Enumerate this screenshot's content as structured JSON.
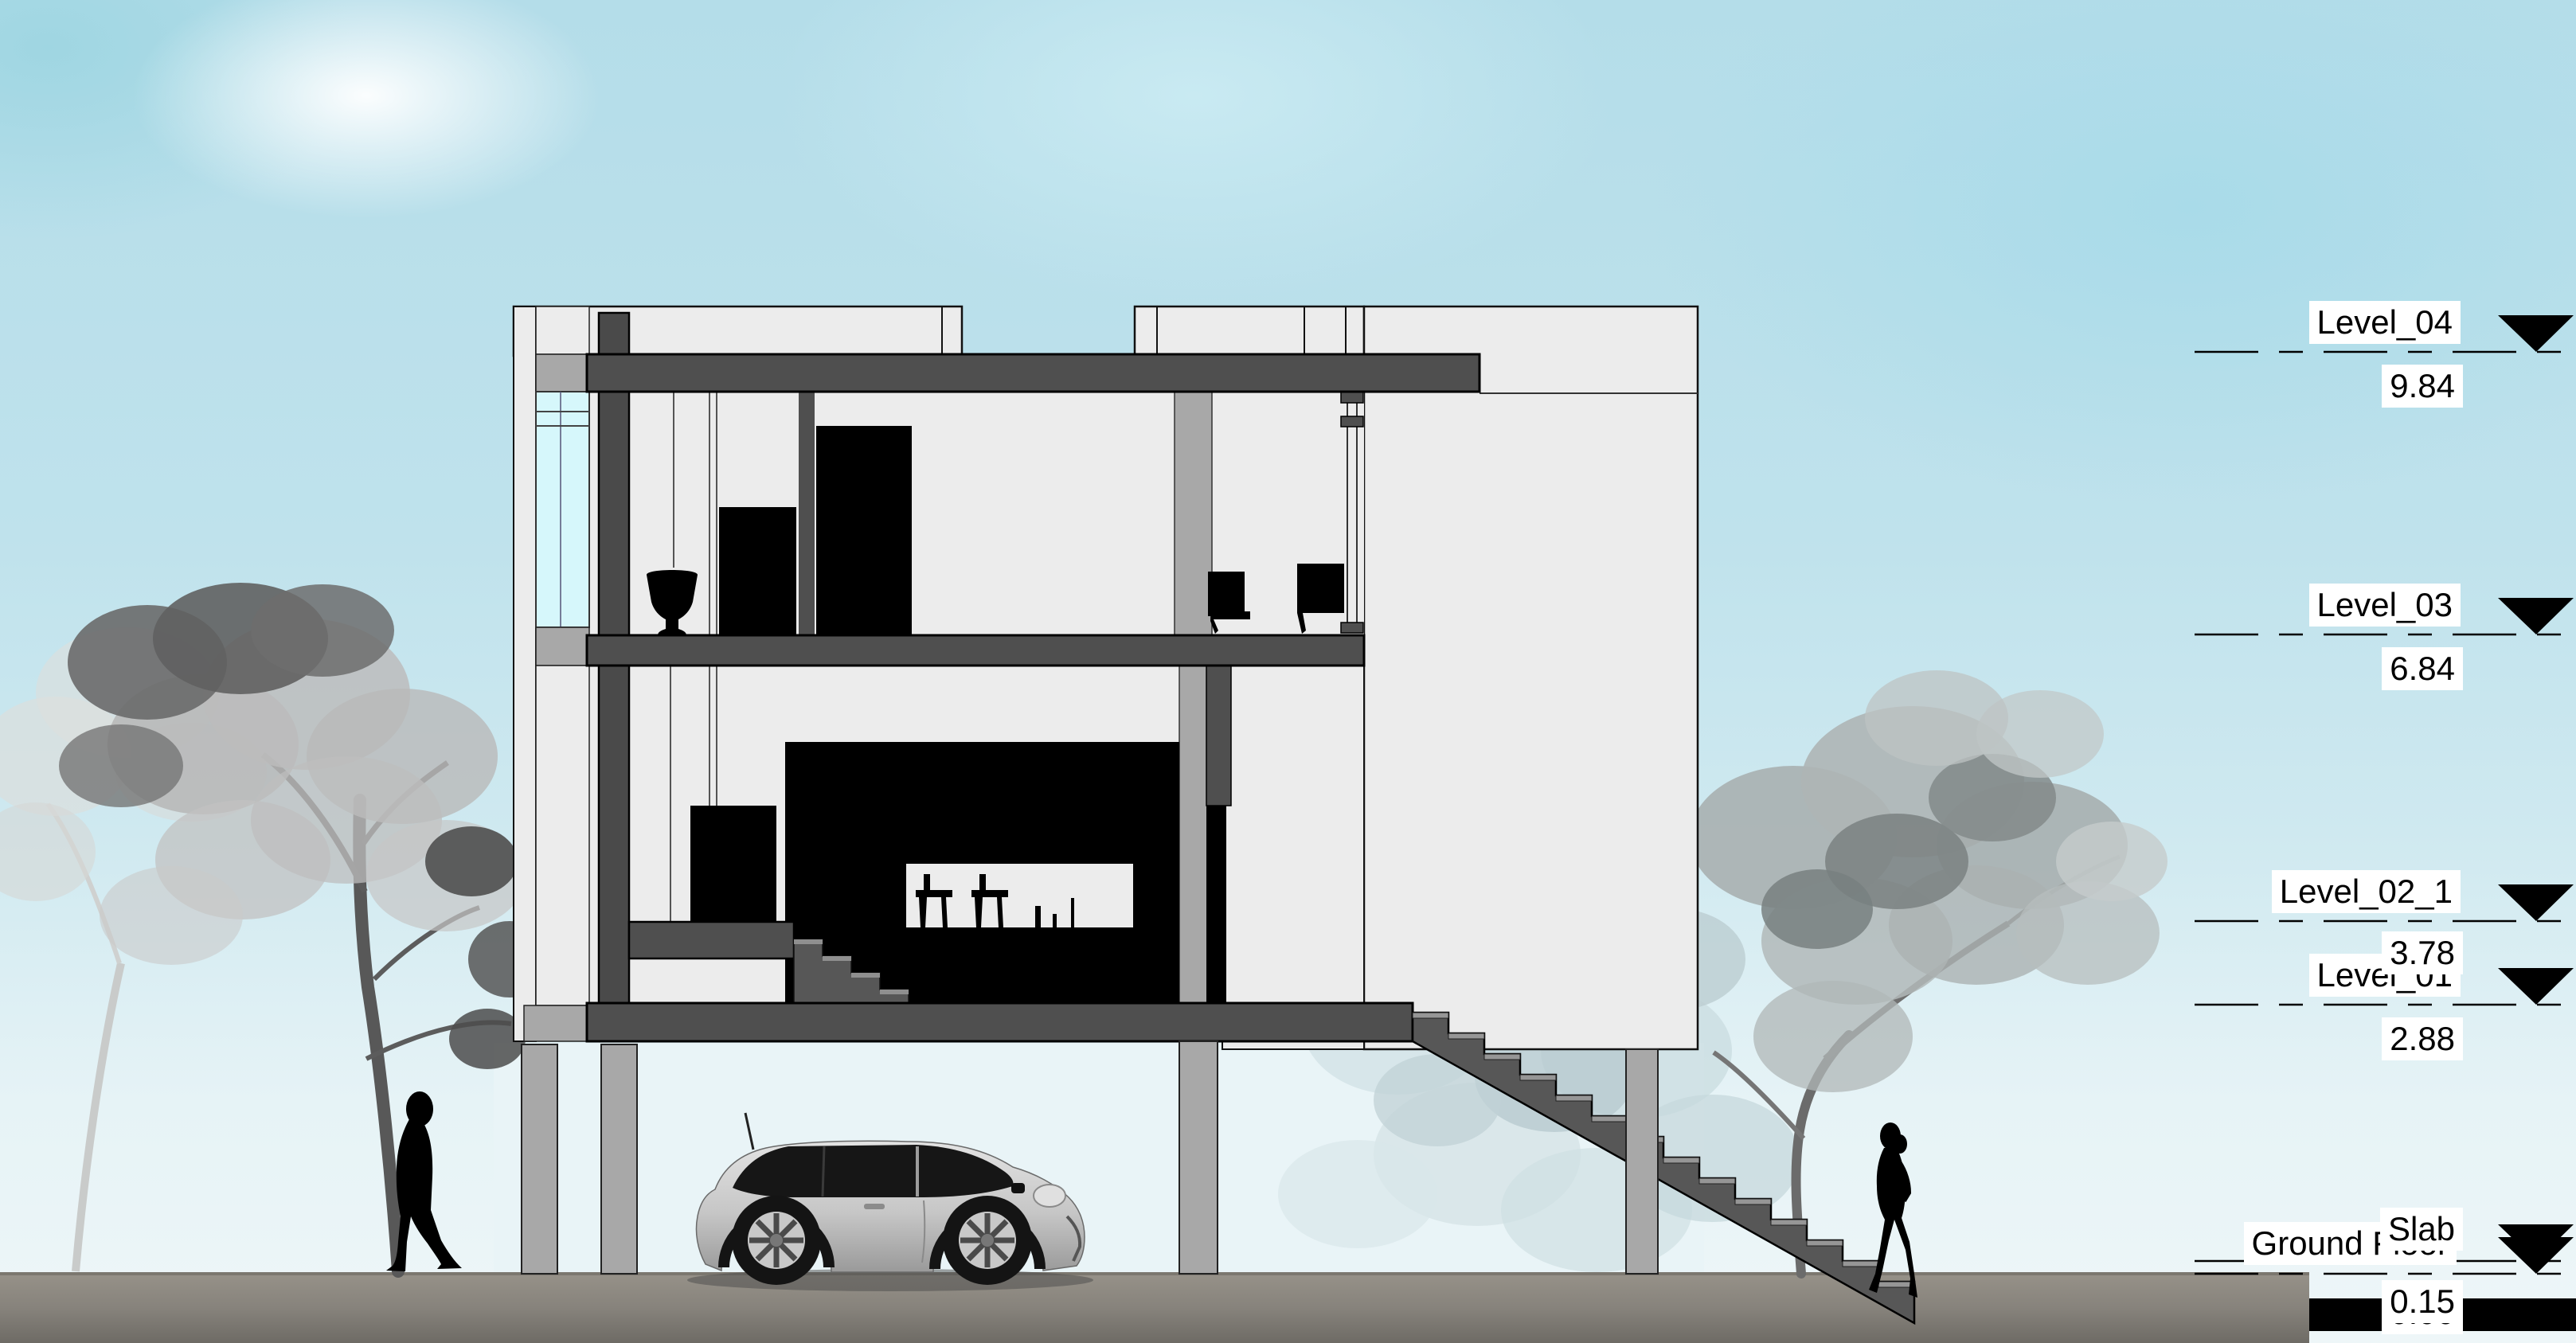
{
  "title": "Building Section Drawing",
  "levels": [
    {
      "label": "Level_04",
      "value": "9.84"
    },
    {
      "label": "Level_03",
      "value": "6.84"
    },
    {
      "label": "Level_02_1",
      "value": "3.78"
    },
    {
      "label": "Level_01",
      "value": "2.88"
    },
    {
      "label": "Slab",
      "value": "0.15"
    },
    {
      "label": "Ground Floor",
      "value": "0.00"
    }
  ],
  "colors": {
    "sky": "#bfe2ec",
    "cut_structure": "#4f4f4f",
    "wall_light": "#ececec",
    "wall_mid": "#a8a8a8",
    "glass": "#d6f7fb",
    "ground": "#8b8781",
    "silhouette": "#000000",
    "marker_triangle": "#000000"
  },
  "scene": {
    "building": "three-storey house section on pilotis with external stair",
    "vehicle": "silver mini hatchback with black roof",
    "figures": [
      "standing man silhouette",
      "walking woman silhouette"
    ],
    "vegetation": [
      "grey tree group left",
      "grey tree group right"
    ]
  }
}
